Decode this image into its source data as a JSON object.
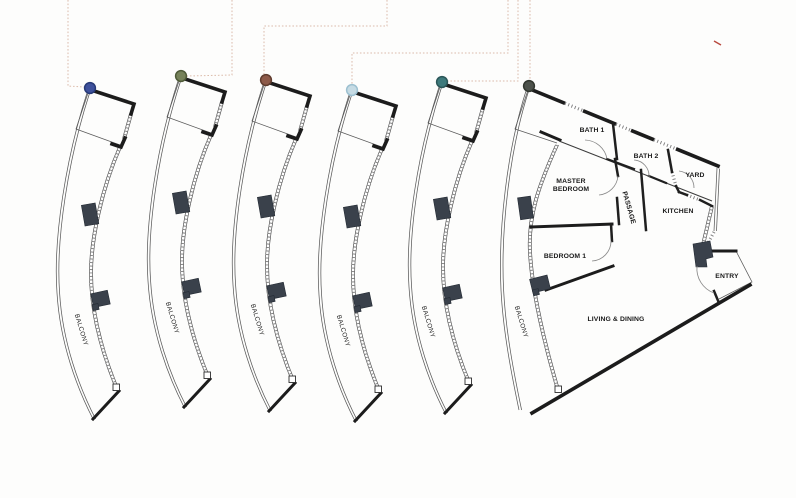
{
  "plan": {
    "type": "floor-plate-with-unit-plans",
    "balcony_label": "BALCONY",
    "rooms": {
      "bath1": "BATH 1",
      "bath2": "BATH 2",
      "yard": "YARD",
      "master_bedroom": "MASTER BEDROOM",
      "passage": "PASSAGE",
      "kitchen": "KITCHEN",
      "bedroom1": "BEDROOM 1",
      "living_dining": "LIVING & DINING",
      "entry": "ENTRY"
    }
  },
  "units": [
    {
      "name": "unit-1",
      "marker_color": "#3e519c",
      "marker_border": "#273a77"
    },
    {
      "name": "unit-2",
      "marker_color": "#76825a",
      "marker_border": "#4e5a38"
    },
    {
      "name": "unit-3",
      "marker_color": "#8d5a49",
      "marker_border": "#5f3c2e"
    },
    {
      "name": "unit-4",
      "marker_color": "#c6dbe4",
      "marker_border": "#9cc0d0"
    },
    {
      "name": "unit-5",
      "marker_color": "#3e7a7c",
      "marker_border": "#2b5658"
    },
    {
      "name": "unit-6",
      "marker_color": "#4d524c",
      "marker_border": "#31362f"
    }
  ],
  "colors": {
    "background": "#fdfdfc",
    "wall": "#1c1c1c",
    "leader_line": "#dcbcab",
    "red_mark": "#b8493e",
    "column_fill": "#3a414b"
  }
}
